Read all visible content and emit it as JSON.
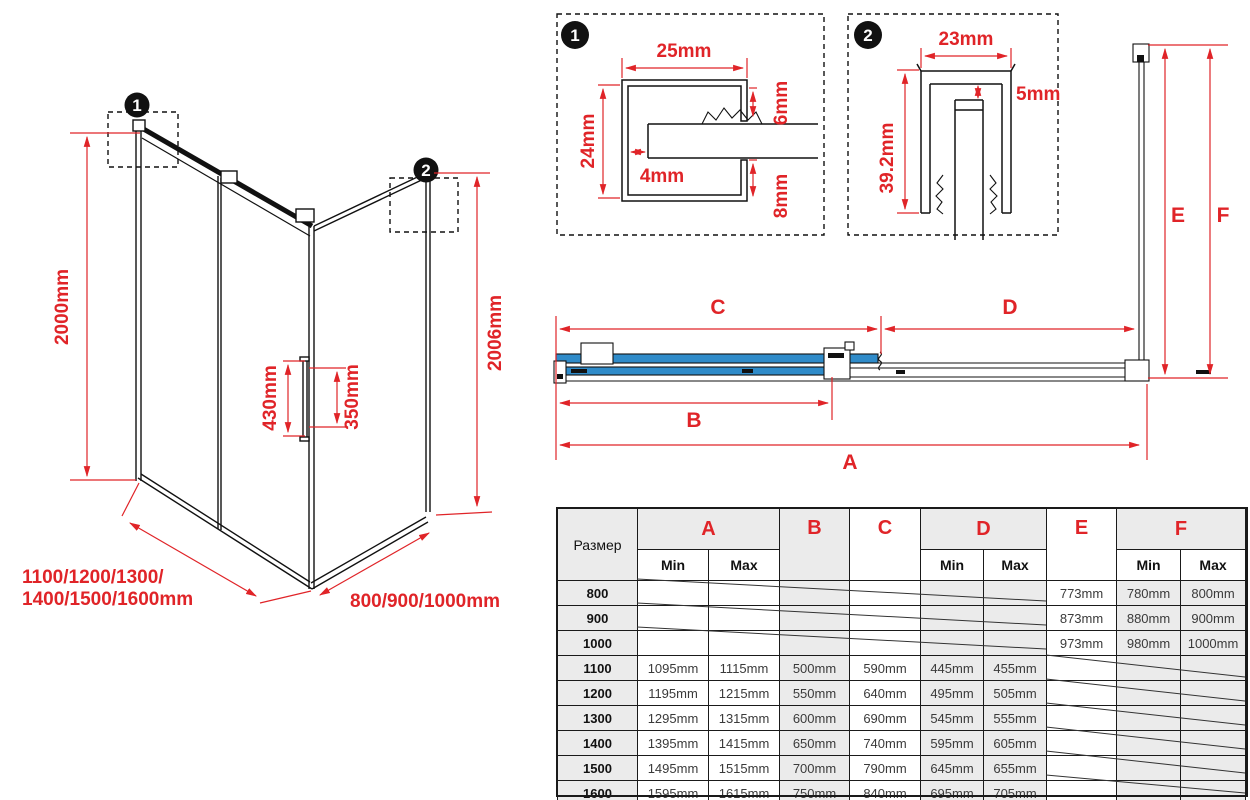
{
  "colors": {
    "red": "#e02428",
    "blue": "#2f8bc9",
    "gray": "#ebebeb",
    "line": "#1a1a1a"
  },
  "iso": {
    "marker1": "1",
    "marker2": "2",
    "height_left": "2000mm",
    "height_right": "2006mm",
    "handle_length": "430mm",
    "handle_holes": "350mm",
    "front_widths_line1": "1100/1200/1300/",
    "front_widths_line2": "1400/1500/1600mm",
    "side_widths": "800/900/1000mm"
  },
  "detail1": {
    "marker": "1",
    "top_width": "25mm",
    "height": "24mm",
    "slot": "4mm",
    "lip_top": "6mm",
    "lip_bottom": "8mm"
  },
  "detail2": {
    "marker": "2",
    "top_width": "23mm",
    "gap": "5mm",
    "height": "39.2mm"
  },
  "plan": {
    "dim_a": "A",
    "dim_b": "B",
    "dim_c": "C",
    "dim_d": "D",
    "dim_e": "E",
    "dim_f": "F"
  },
  "table": {
    "size_header": "Размер",
    "col_a": "A",
    "col_b": "B",
    "col_c": "C",
    "col_d": "D",
    "col_e": "E",
    "col_f": "F",
    "min": "Min",
    "max": "Max",
    "rows": [
      {
        "size": "800",
        "a_min": "",
        "a_max": "",
        "b": "",
        "c": "",
        "d_min": "",
        "d_max": "",
        "e": "773mm",
        "f_min": "780mm",
        "f_max": "800mm"
      },
      {
        "size": "900",
        "a_min": "",
        "a_max": "",
        "b": "",
        "c": "",
        "d_min": "",
        "d_max": "",
        "e": "873mm",
        "f_min": "880mm",
        "f_max": "900mm"
      },
      {
        "size": "1000",
        "a_min": "",
        "a_max": "",
        "b": "",
        "c": "",
        "d_min": "",
        "d_max": "",
        "e": "973mm",
        "f_min": "980mm",
        "f_max": "1000mm"
      },
      {
        "size": "1100",
        "a_min": "1095mm",
        "a_max": "1115mm",
        "b": "500mm",
        "c": "590mm",
        "d_min": "445mm",
        "d_max": "455mm",
        "e": "",
        "f_min": "",
        "f_max": ""
      },
      {
        "size": "1200",
        "a_min": "1195mm",
        "a_max": "1215mm",
        "b": "550mm",
        "c": "640mm",
        "d_min": "495mm",
        "d_max": "505mm",
        "e": "",
        "f_min": "",
        "f_max": ""
      },
      {
        "size": "1300",
        "a_min": "1295mm",
        "a_max": "1315mm",
        "b": "600mm",
        "c": "690mm",
        "d_min": "545mm",
        "d_max": "555mm",
        "e": "",
        "f_min": "",
        "f_max": ""
      },
      {
        "size": "1400",
        "a_min": "1395mm",
        "a_max": "1415mm",
        "b": "650mm",
        "c": "740mm",
        "d_min": "595mm",
        "d_max": "605mm",
        "e": "",
        "f_min": "",
        "f_max": ""
      },
      {
        "size": "1500",
        "a_min": "1495mm",
        "a_max": "1515mm",
        "b": "700mm",
        "c": "790mm",
        "d_min": "645mm",
        "d_max": "655mm",
        "e": "",
        "f_min": "",
        "f_max": ""
      },
      {
        "size": "1600",
        "a_min": "1595mm",
        "a_max": "1615mm",
        "b": "750mm",
        "c": "840mm",
        "d_min": "695mm",
        "d_max": "705mm",
        "e": "",
        "f_min": "",
        "f_max": ""
      }
    ]
  }
}
